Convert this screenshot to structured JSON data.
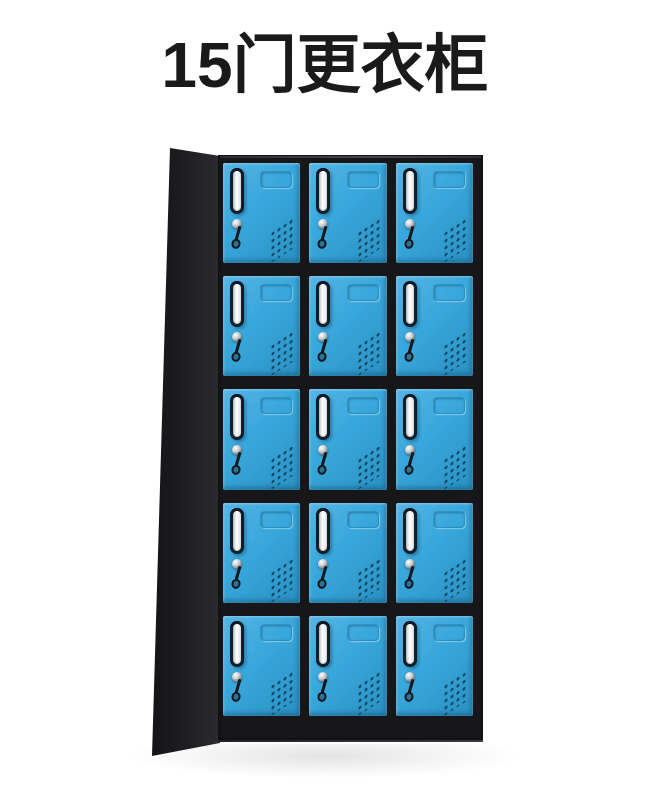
{
  "page_title": {
    "text": "15门更衣柜"
  },
  "product_image": {
    "description": "black steel locker cabinet with 15 blue doors",
    "grid": {
      "rows": 5,
      "columns": 3,
      "door_count": 15
    },
    "door_features": [
      "chrome-recessed-handle",
      "label-emboss",
      "keyhole-lock",
      "hanging-key",
      "vent-holes"
    ],
    "colors": {
      "background": "#ffffff",
      "title_text": "#1a1a1a",
      "door_blue": "#38a7db",
      "door_blue_light": "#55b5e6",
      "door_blue_dark": "#2a90c2",
      "cabinet_black": "#17171a",
      "side_panel_dark": "#202023",
      "handle_chrome_light": "#ffffff",
      "handle_chrome_dark": "#b9bfc4",
      "handle_recess": "#10222e",
      "lock_chrome": "#c7ccd1",
      "key_black": "#14181c",
      "vent_dot": "#0d3e58"
    }
  }
}
